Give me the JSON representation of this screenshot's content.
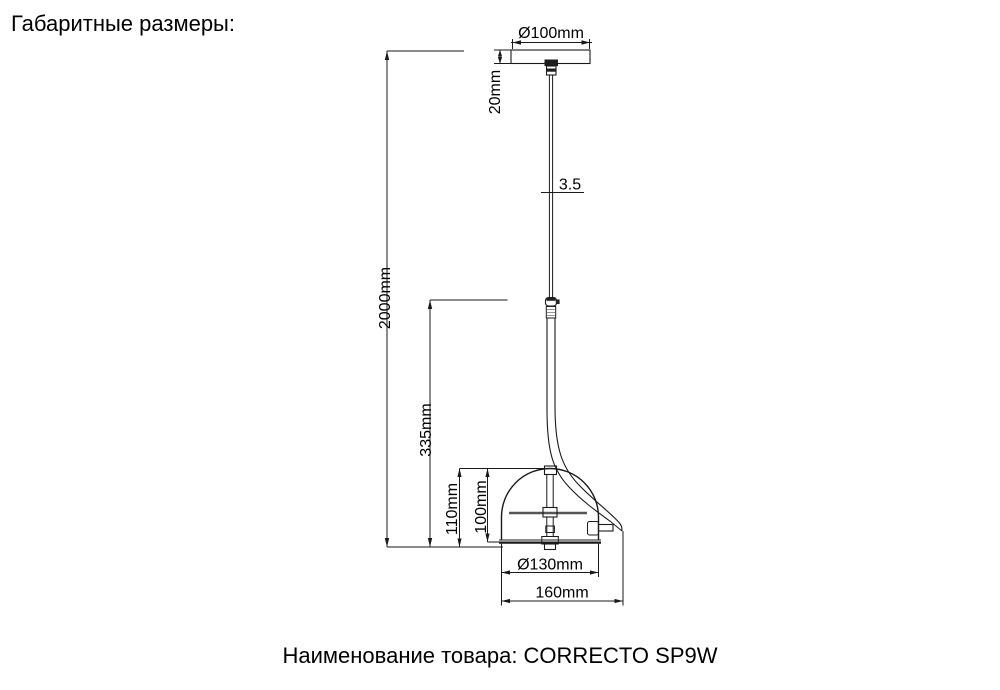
{
  "header": {
    "title": "Габаритные размеры:"
  },
  "footer": {
    "product_label": "Наименование товара: CORRECTO SP9W"
  },
  "drawing": {
    "type": "technical-dimension-drawing",
    "product_name": "CORRECTO SP9W",
    "line_color": "#1a1a1a",
    "background_color": "#ffffff",
    "dimensions": {
      "canopy_diameter": "Ø100mm",
      "canopy_height": "20mm",
      "cable_diameter": "3.5",
      "overall_height": "2000mm",
      "lower_assembly_height": "335mm",
      "shade_outer_height": "110mm",
      "shade_inner_height": "100mm",
      "shade_diameter": "Ø130mm",
      "overall_width": "160mm"
    }
  }
}
